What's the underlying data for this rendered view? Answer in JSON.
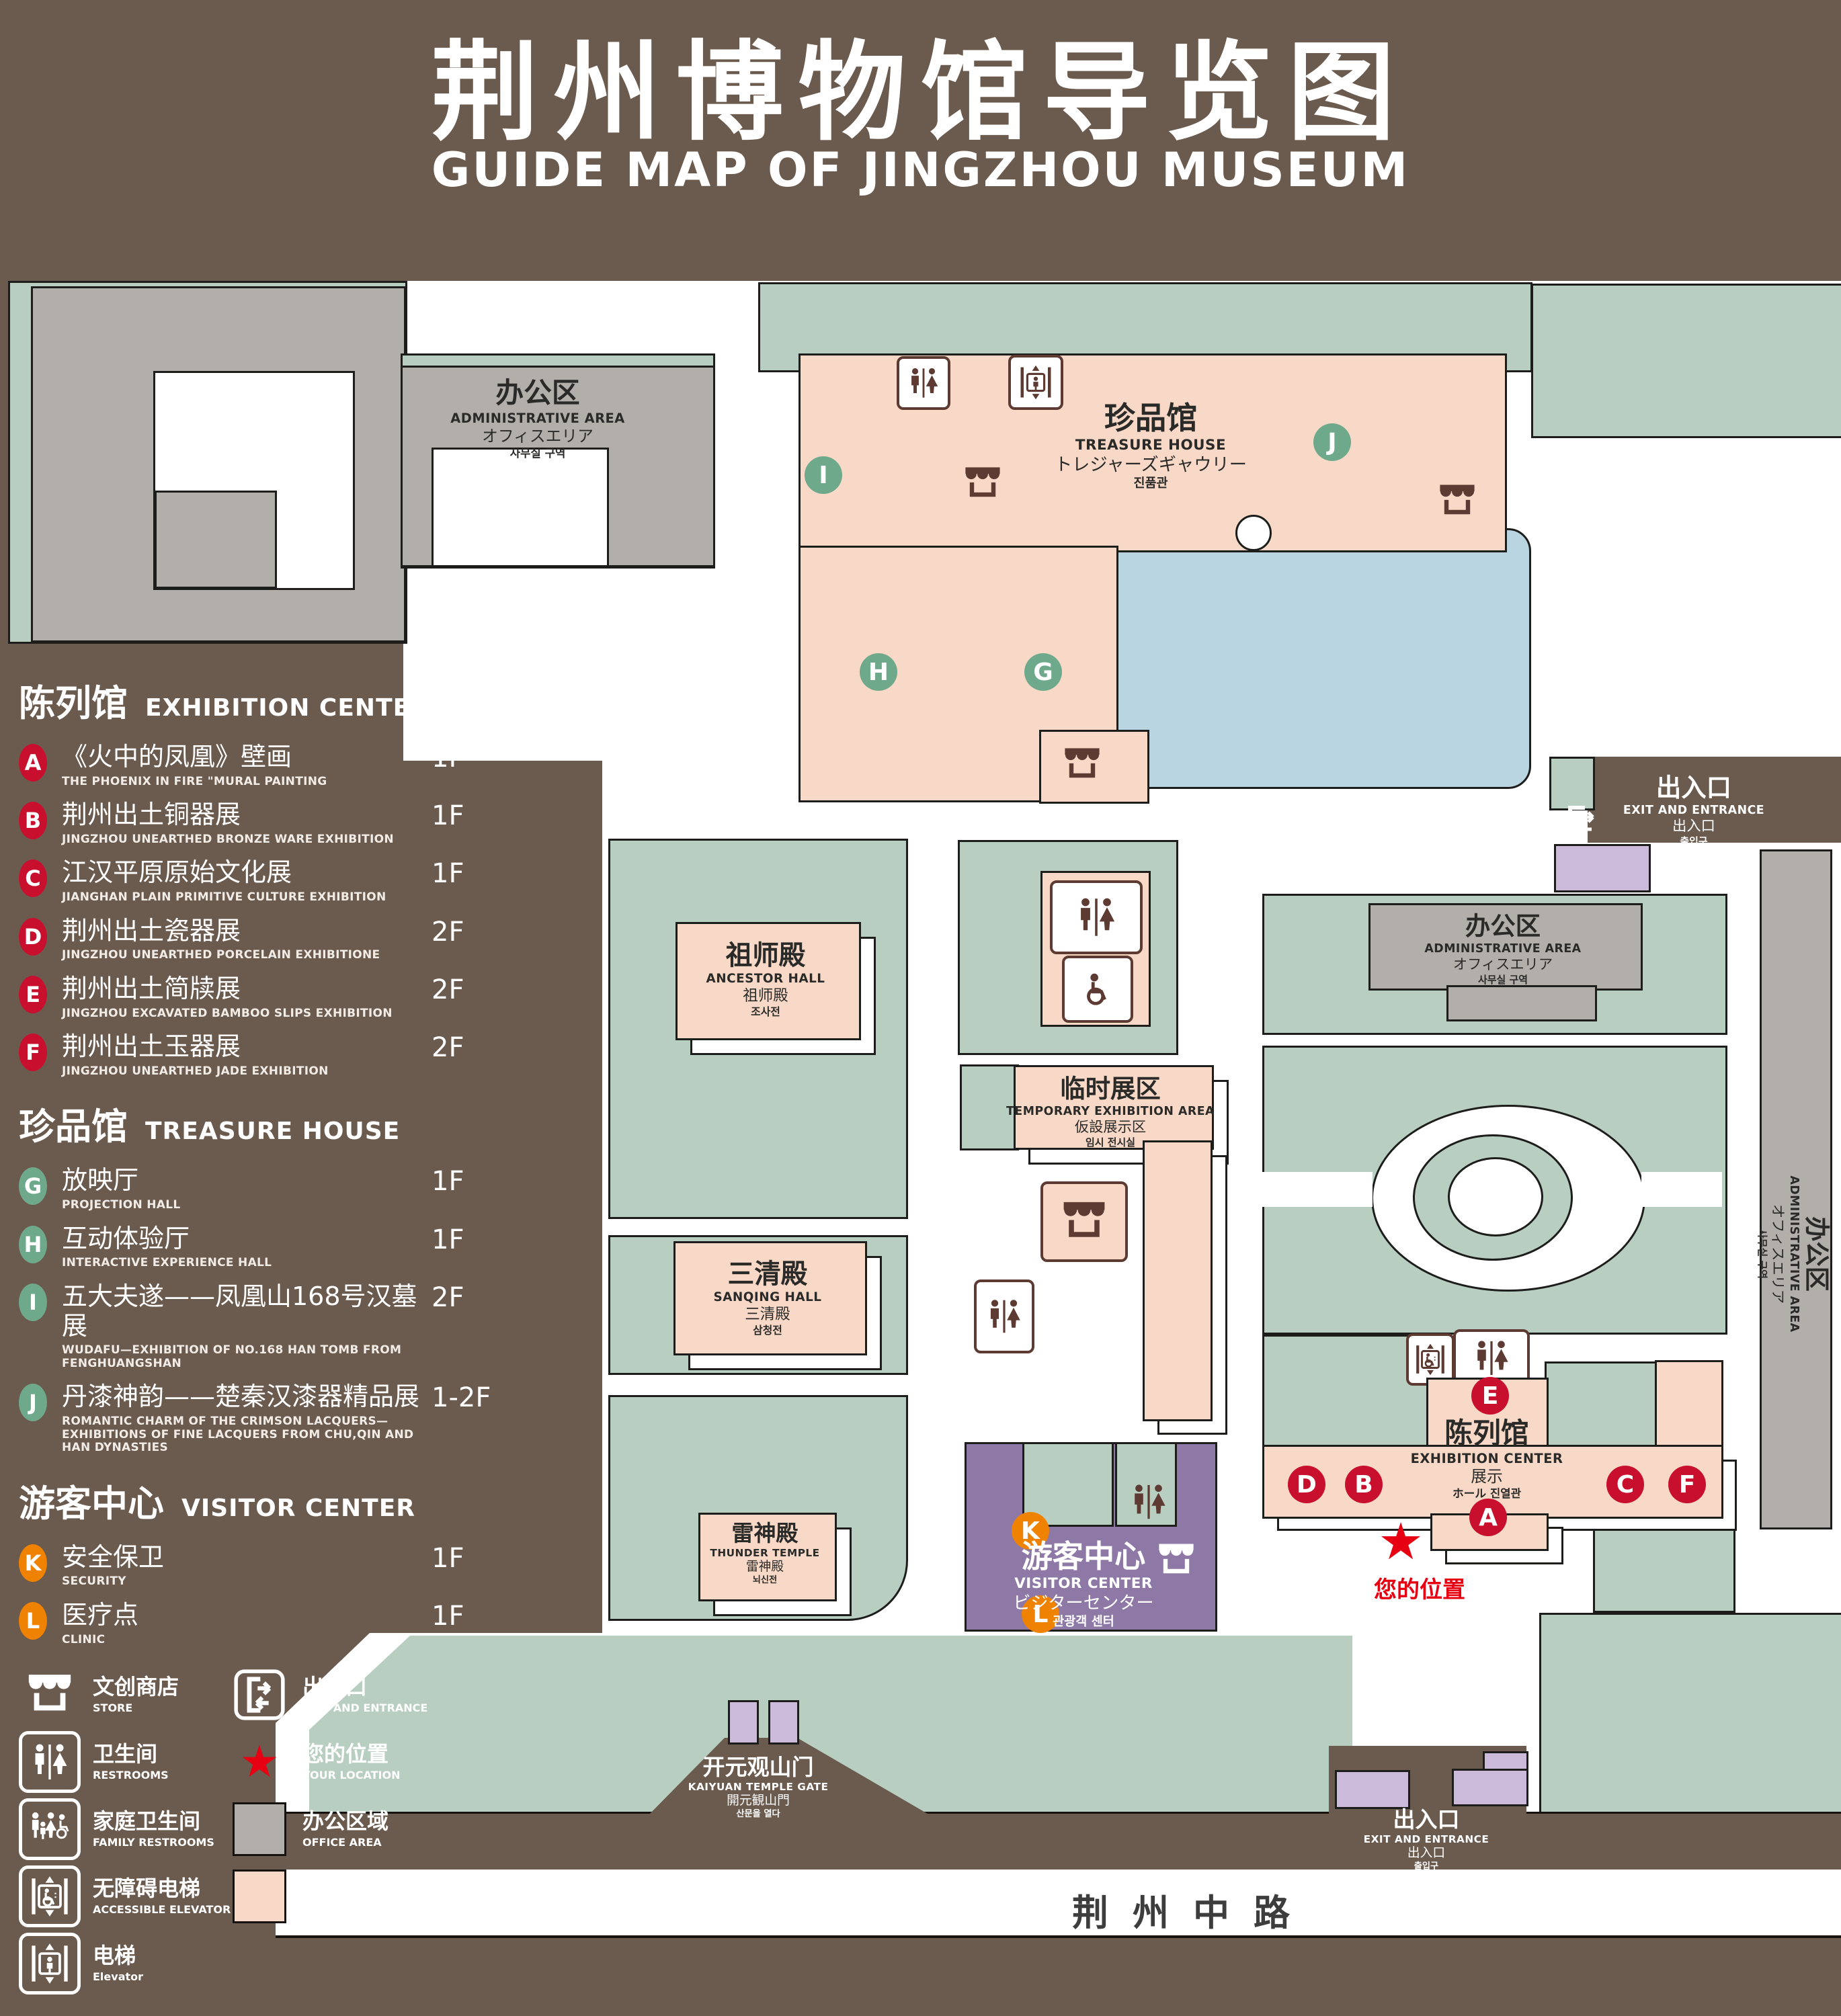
{
  "header": {
    "title": "荆州博物馆导览图",
    "subtitle": "GUIDE MAP OF JINGZHOU MUSEUM"
  },
  "legend": {
    "sections": [
      {
        "title_zh": "陈列馆",
        "title_en": "EXHIBITION CENTER",
        "items": [
          {
            "letter": "A",
            "zh": "《火中的凤凰》壁画",
            "en": "THE PHOENIX IN FIRE \"MURAL PAINTING",
            "floor": "1F"
          },
          {
            "letter": "B",
            "zh": "荆州出土铜器展",
            "en": "JINGZHOU UNEARTHED BRONZE WARE EXHIBITION",
            "floor": "1F"
          },
          {
            "letter": "C",
            "zh": "江汉平原原始文化展",
            "en": "JIANGHAN PLAIN PRIMITIVE CULTURE EXHIBITION",
            "floor": "1F"
          },
          {
            "letter": "D",
            "zh": "荆州出土瓷器展",
            "en": "JINGZHOU UNEARTHED PORCELAIN EXHIBITIONE",
            "floor": "2F"
          },
          {
            "letter": "E",
            "zh": "荆州出土简牍展",
            "en": "JINGZHOU EXCAVATED BAMBOO SLIPS EXHIBITION",
            "floor": "2F"
          },
          {
            "letter": "F",
            "zh": "荆州出土玉器展",
            "en": "JINGZHOU UNEARTHED JADE EXHIBITION",
            "floor": "2F"
          }
        ]
      },
      {
        "title_zh": "珍品馆",
        "title_en": "TREASURE HOUSE",
        "items": [
          {
            "letter": "G",
            "zh": "放映厅",
            "en": "PROJECTION HALL",
            "floor": "1F"
          },
          {
            "letter": "H",
            "zh": "互动体验厅",
            "en": "INTERACTIVE EXPERIENCE HALL",
            "floor": "1F"
          },
          {
            "letter": "I",
            "zh": "五大夫遂——凤凰山168号汉墓展",
            "en": "WUDAFU—EXHIBITION OF NO.168 HAN TOMB FROM FENGHUANGSHAN",
            "floor": "2F"
          },
          {
            "letter": "J",
            "zh": "丹漆神韵——楚秦汉漆器精品展",
            "en": "ROMANTIC CHARM OF THE CRIMSON LACQUERS—EXHIBITIONS OF FINE LACQUERS FROM CHU,QIN AND HAN DYNASTIES",
            "floor": "1-2F"
          }
        ]
      },
      {
        "title_zh": "游客中心",
        "title_en": "VISITOR CENTER",
        "items": [
          {
            "letter": "K",
            "zh": "安全保卫",
            "en": "SECURITY",
            "floor": "1F"
          },
          {
            "letter": "L",
            "zh": "医疗点",
            "en": "CLINIC",
            "floor": "1F"
          }
        ]
      }
    ],
    "symbols": {
      "store": {
        "zh": "文创商店",
        "en": "STORE"
      },
      "exit": {
        "zh": "出入口",
        "en": "EXIT AND ENTRANCE"
      },
      "restroom": {
        "zh": "卫生间",
        "en": "RESTROOMS"
      },
      "location": {
        "zh": "您的位置",
        "en": "YOUR LOCATION"
      },
      "family": {
        "zh": "家庭卫生间",
        "en": "FAMILY RESTROOMS"
      },
      "office": {
        "zh": "办公区域",
        "en": "OFFICE AREA"
      },
      "accessible_elevator": {
        "zh": "无障碍电梯",
        "en": "ACCESSIBLE ELEVATOR"
      },
      "display": {
        "zh": "展示区域",
        "en": "DISPLAY AREA"
      },
      "elevator": {
        "zh": "电梯",
        "en": "Elevator"
      }
    }
  },
  "map": {
    "labels": {
      "admin": {
        "zh": "办公区",
        "en": "ADMINISTRATIVE AREA",
        "jp": "オフィスエリア",
        "kr": "사무실 구역"
      },
      "treasure": {
        "zh": "珍品馆",
        "en": "TREASURE HOUSE",
        "jp": "トレジャーズギャウリー",
        "kr": "진품관"
      },
      "ancestor": {
        "zh": "祖师殿",
        "en": "ANCESTOR HALL",
        "jp": "祖师殿",
        "kr": "조사전"
      },
      "temporary": {
        "zh": "临时展区",
        "en": "TEMPORARY EXHIBITION AREA",
        "jp": "仮設展示区",
        "kr": "임시 전시실"
      },
      "sanqing": {
        "zh": "三清殿",
        "en": "SANQING HALL",
        "jp": "三清殿",
        "kr": "삼청전"
      },
      "thunder": {
        "zh": "雷神殿",
        "en": "THUNDER TEMPLE",
        "jp": "雷神殿",
        "kr": "뇌신전"
      },
      "visitor": {
        "zh": "游客中心",
        "en": "VISITOR CENTER",
        "jp": "ビジターセンター",
        "kr": "관광객 센터"
      },
      "exhibition": {
        "zh": "陈列馆",
        "en": "EXHIBITION CENTER",
        "jp": "展示",
        "kr": "ホール 진열관"
      },
      "gate": {
        "zh": "开元观山门",
        "en": "KAIYUAN TEMPLE GATE",
        "jp": "開元観山門",
        "kr": "산문을 열다"
      },
      "exit": {
        "zh": "出入口",
        "en": "EXIT AND ENTRANCE",
        "jp": "出入口",
        "kr": "출입구"
      },
      "your_location": "您的位置",
      "road": "荆州中路"
    },
    "markers": [
      {
        "letter": "A"
      },
      {
        "letter": "B"
      },
      {
        "letter": "C"
      },
      {
        "letter": "D"
      },
      {
        "letter": "E"
      },
      {
        "letter": "F"
      },
      {
        "letter": "G"
      },
      {
        "letter": "H"
      },
      {
        "letter": "I"
      },
      {
        "letter": "J"
      },
      {
        "letter": "K"
      },
      {
        "letter": "L"
      }
    ]
  },
  "colors": {
    "background": "#6b5a4e",
    "landscape_green": "#b7cec0",
    "display_pink": "#f8d8c6",
    "office_gray": "#b2aeaa",
    "water_blue": "#b9d5e1",
    "visitor_purple": "#8e79a6",
    "light_purple": "#ccbada",
    "marker_red": "#c8102e",
    "marker_green": "#6fa98c",
    "marker_orange": "#ef8200",
    "location_red": "#e60012",
    "icon_brown": "#5d3b33"
  }
}
